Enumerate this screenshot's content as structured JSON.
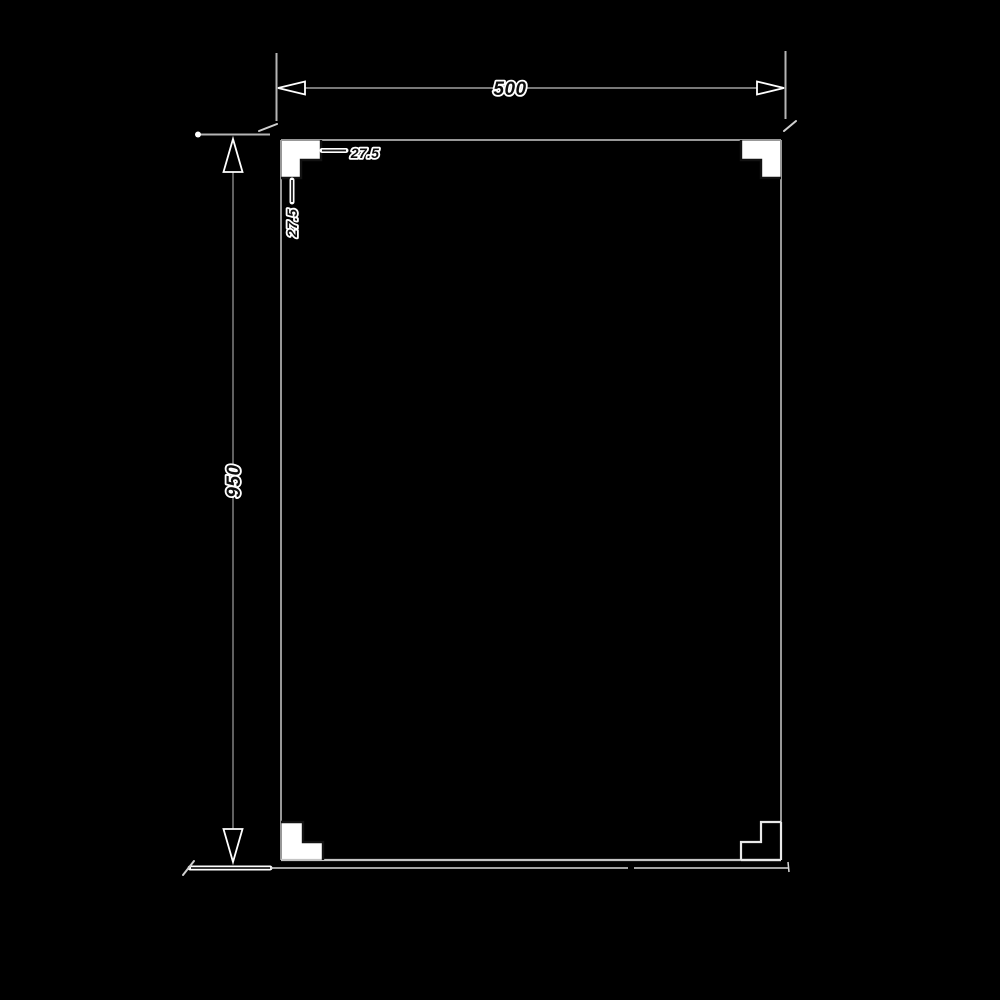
{
  "drawing": {
    "kind": "technical-dimension-drawing",
    "background_color": "#000000",
    "outline_color": "#989898",
    "halo_color": "#ffffff",
    "dimension_text_color": "#0d0d0d",
    "labels": {
      "width": "500",
      "height": "950",
      "notch_horizontal": "27.5",
      "notch_vertical": "27.5"
    },
    "dimensions": {
      "panel_width_mm": 500,
      "panel_height_mm": 950,
      "corner_step_mm": 27.5
    }
  }
}
